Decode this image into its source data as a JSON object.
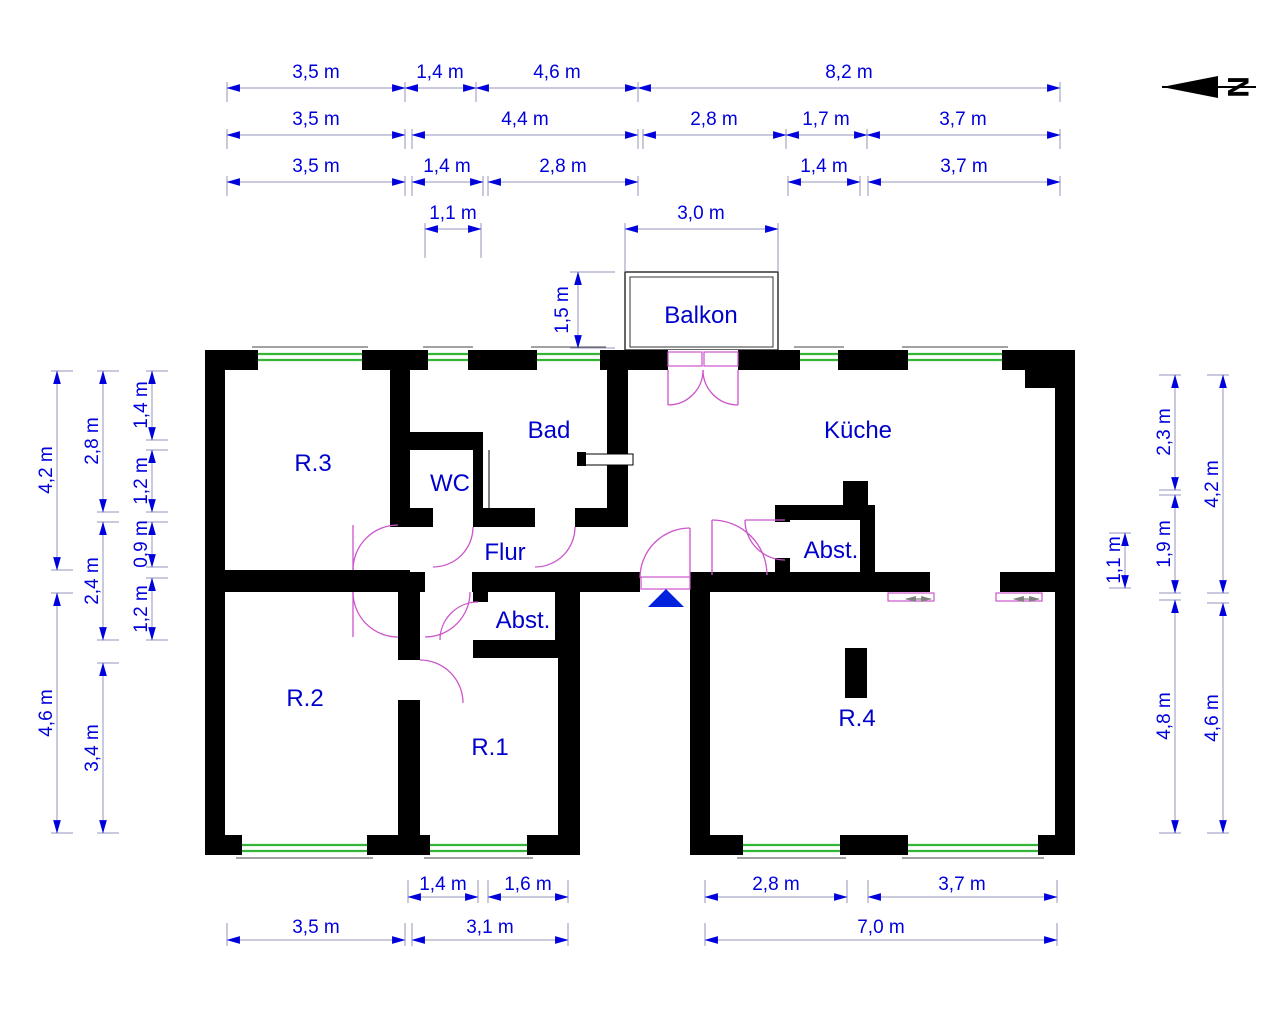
{
  "north": {
    "label": "N"
  },
  "rooms": {
    "balkon": "Balkon",
    "bad": "Bad",
    "wc": "WC",
    "kueche": "Küche",
    "flur": "Flur",
    "abst_left": "Abst.",
    "abst_right": "Abst.",
    "r1": "R.1",
    "r2": "R.2",
    "r3": "R.3",
    "r4": "R.4"
  },
  "dims_top": {
    "row1": [
      "3,5 m",
      "1,4 m",
      "4,6 m",
      "8,2 m"
    ],
    "row2": [
      "3,5 m",
      "4,4 m",
      "2,8 m",
      "1,7 m",
      "3,7 m"
    ],
    "row3": [
      "3,5 m",
      "1,4 m",
      "2,8 m",
      "1,4 m",
      "3,7 m"
    ],
    "row4": [
      "1,1 m",
      "3,0 m"
    ]
  },
  "dims_bottom": {
    "row_upper": [
      "1,4 m",
      "1,6 m",
      "2,8 m",
      "3,7 m"
    ],
    "row_lower": [
      "3,5 m",
      "3,1 m",
      "7,0 m"
    ]
  },
  "dims_left": {
    "outer": [
      "4,2 m",
      "4,6 m"
    ],
    "middle": [
      "2,8 m",
      "2,4 m",
      "3,4 m"
    ],
    "inner": [
      "1,4 m",
      "1,2 m",
      "0,9 m",
      "1,2 m"
    ]
  },
  "dims_right": {
    "innermost": [
      "1,1 m"
    ],
    "middle": [
      "2,3 m",
      "1,9 m",
      "4,8 m"
    ],
    "outer": [
      "4,2 m",
      "4,6 m"
    ]
  },
  "dims_balcony": {
    "depth": "1,5 m"
  },
  "colors": {
    "wall": "#000000",
    "window": "#35b535",
    "dim_text": "#0000dd",
    "dim_line": "#9494bd",
    "door": "#cc55cc",
    "room_label": "#0000cc",
    "entrance_marker": "#0022dd"
  }
}
